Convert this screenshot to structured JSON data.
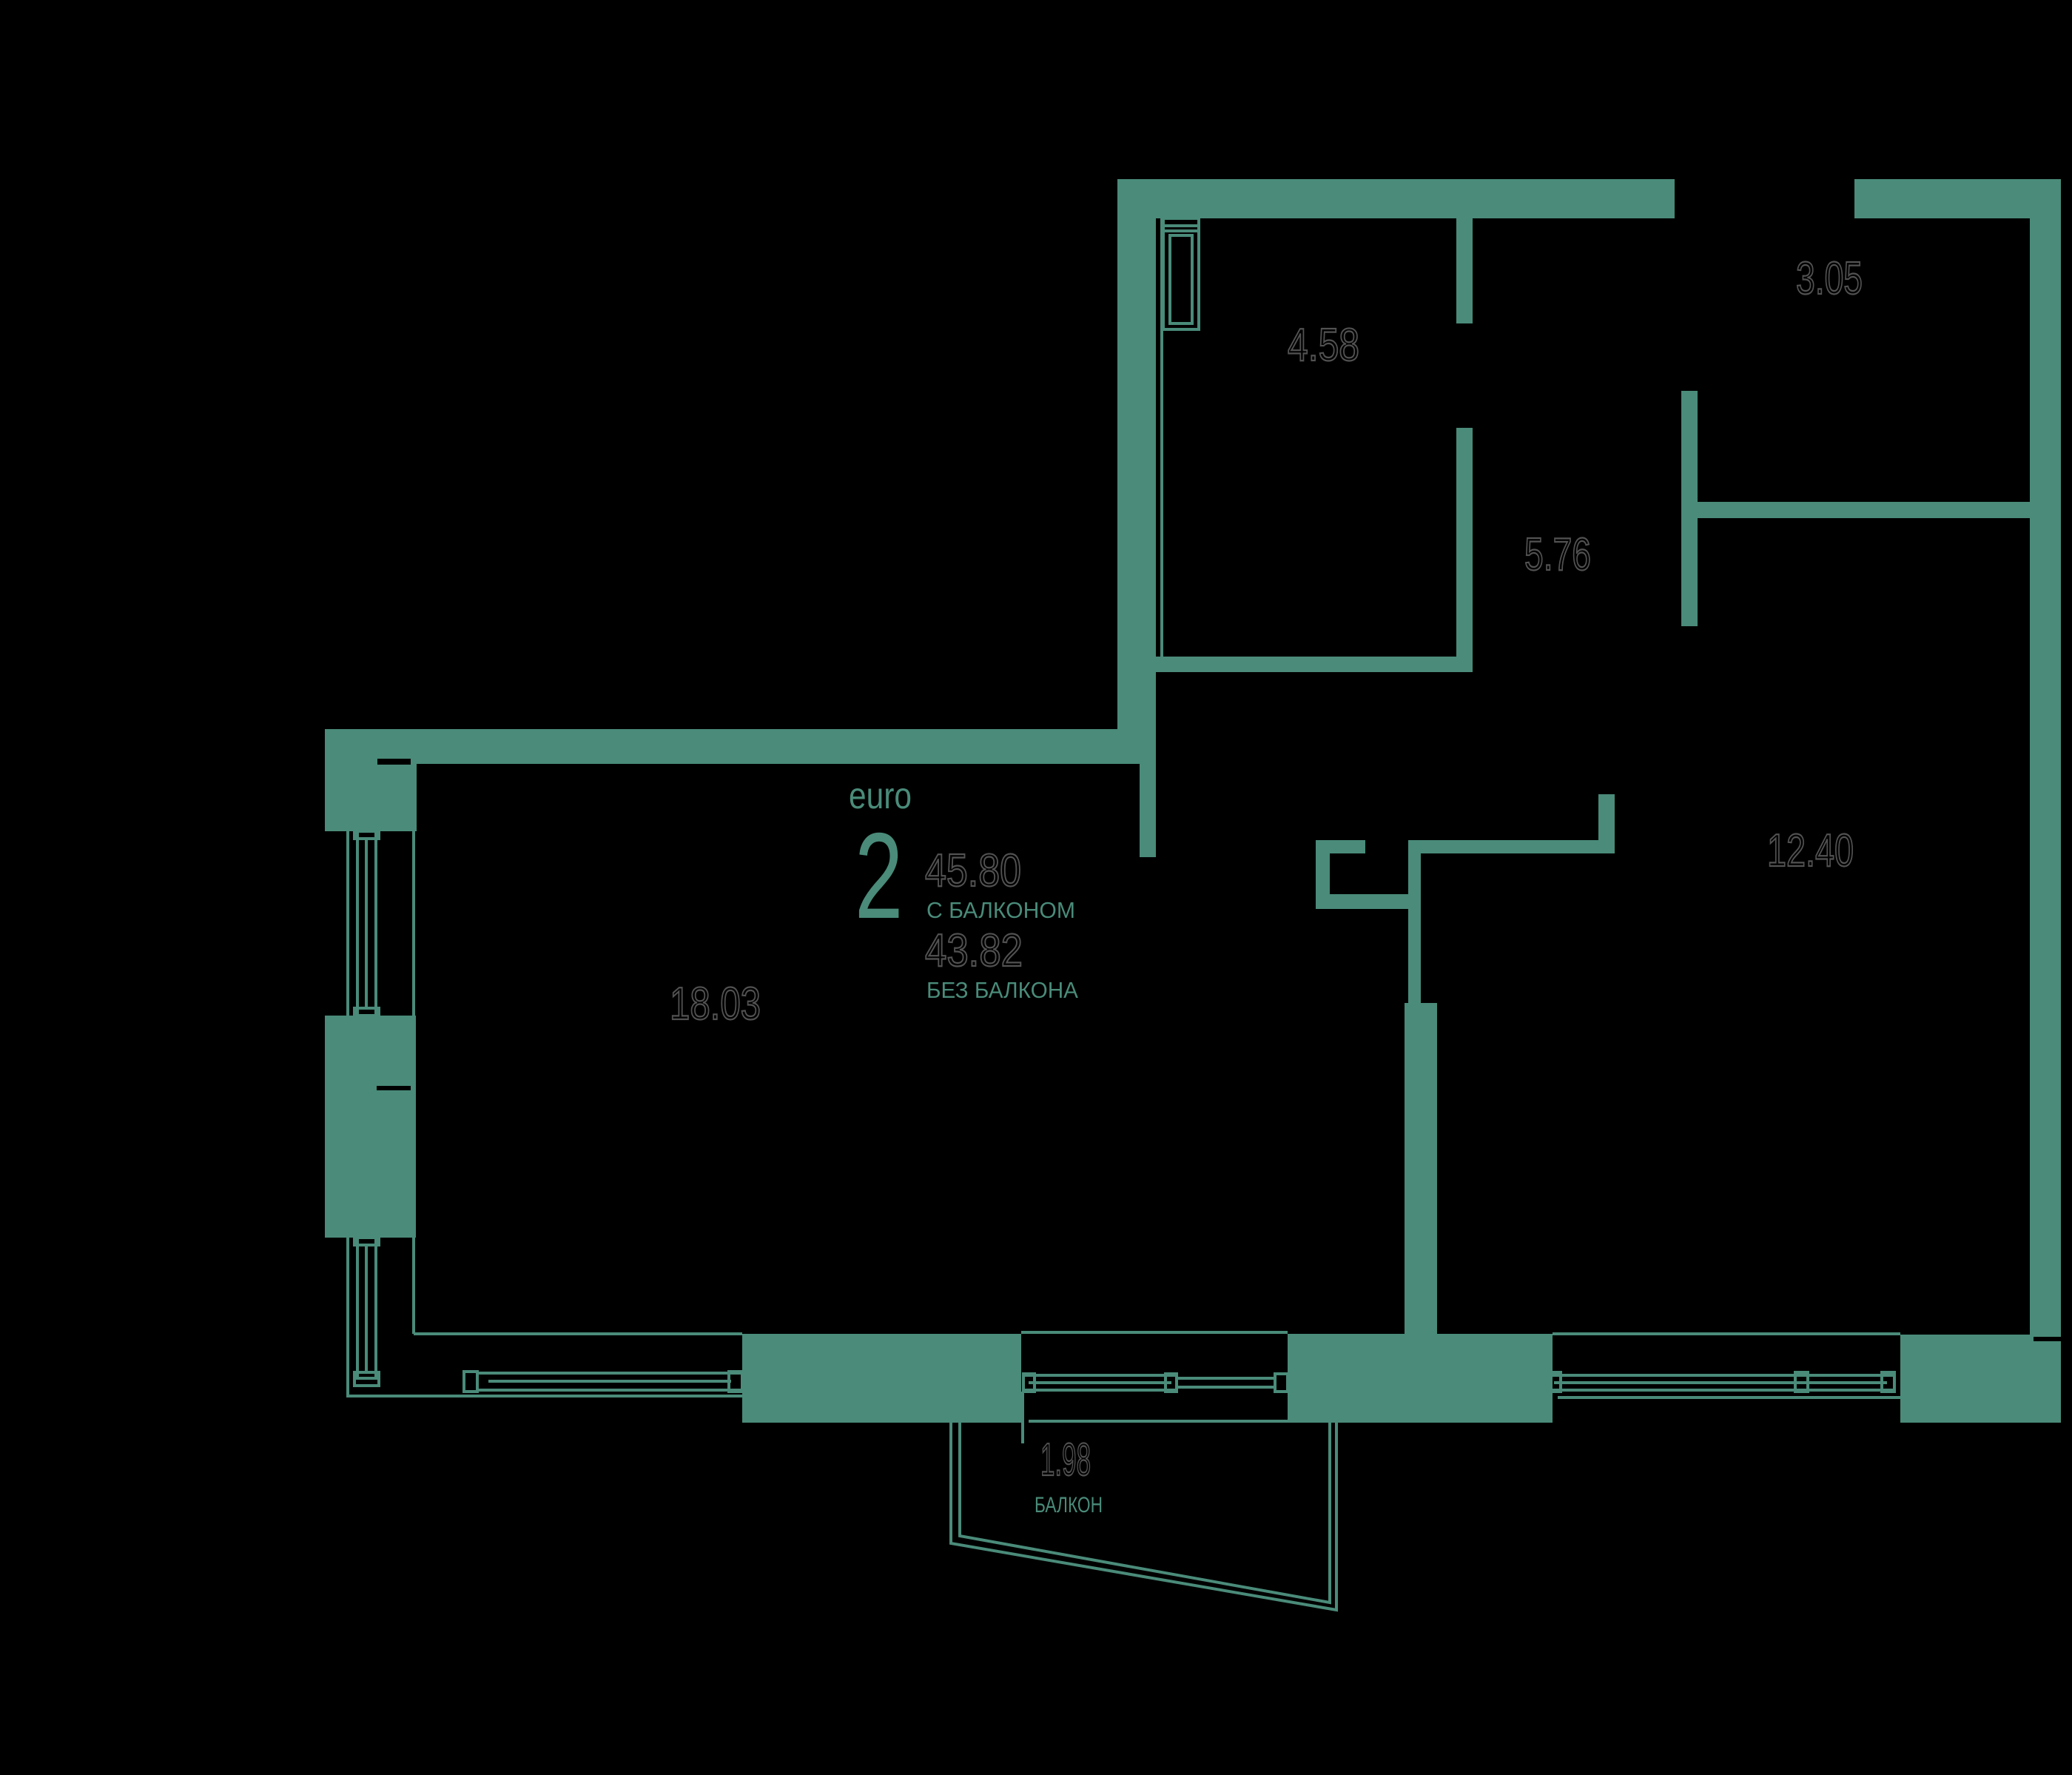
{
  "plan": {
    "title_block": {
      "unit_type_label": "euro",
      "rooms_count": "2",
      "area_with_balcony": "45.80",
      "with_balcony_label": "С БАЛКОНОМ",
      "area_without_balcony": "43.82",
      "without_balcony_label": "БЕЗ БАЛКОНА"
    },
    "rooms": [
      {
        "id": "bathroom",
        "area": "4.58"
      },
      {
        "id": "wardrobe",
        "area": "3.05"
      },
      {
        "id": "hallway",
        "area": "5.76"
      },
      {
        "id": "bedroom",
        "area": "12.40"
      },
      {
        "id": "living-kitchen",
        "area": "18.03"
      },
      {
        "id": "balcony",
        "area": "1.98",
        "label": "БАЛКОН"
      }
    ],
    "colors": {
      "background": "#000000",
      "wall": "#4A8B79",
      "area_text_outline": "#525252"
    }
  }
}
